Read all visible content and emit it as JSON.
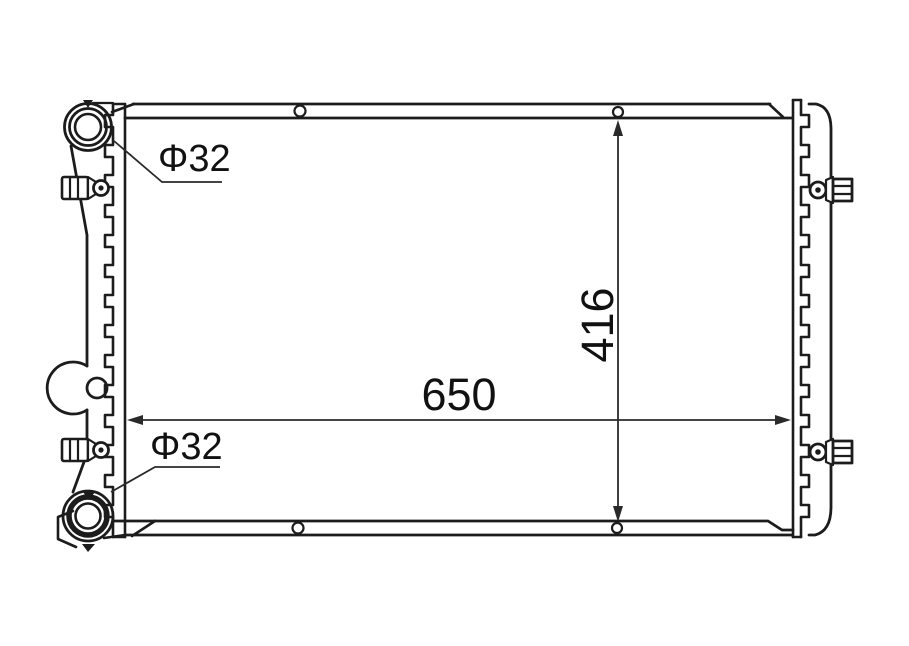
{
  "drawing": {
    "labels": {
      "top_port_diameter": "Φ32",
      "bottom_port_diameter": "Φ32",
      "overall_width": "650",
      "core_height": "416"
    },
    "dimensions": [
      {
        "name": "overall-width",
        "value": 650
      },
      {
        "name": "core-height",
        "value": 416
      },
      {
        "name": "port-diameter",
        "value": 32,
        "occurrences": 2
      }
    ],
    "colors": {
      "line": "#1c1c1c",
      "background": "#ffffff"
    }
  }
}
